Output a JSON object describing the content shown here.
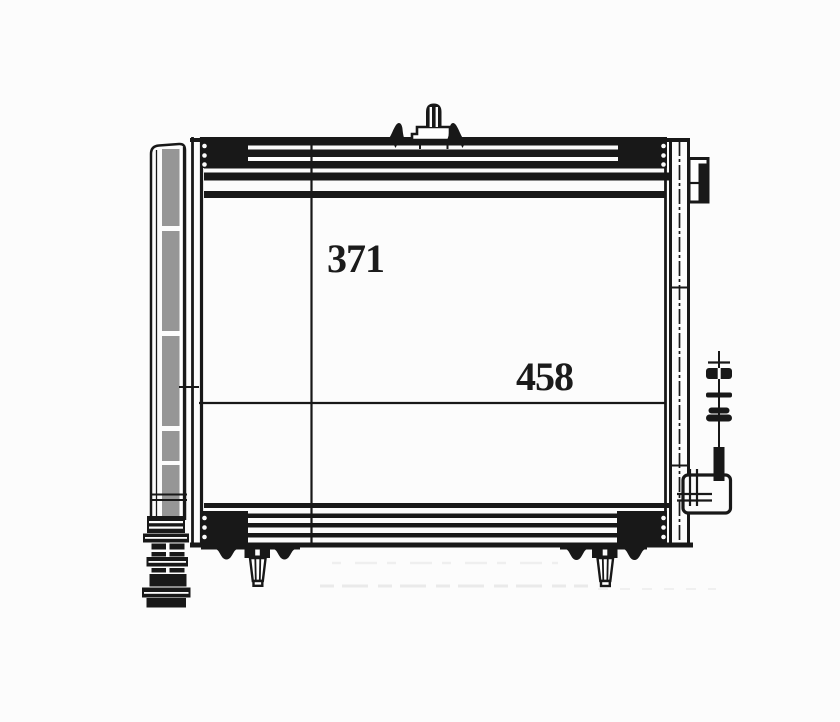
{
  "diagram": {
    "dimension_labels": {
      "height": "371",
      "width": "458"
    },
    "colors": {
      "line": "#181818",
      "background": "#fcfcfc",
      "receiver_shade": "#969696"
    }
  }
}
